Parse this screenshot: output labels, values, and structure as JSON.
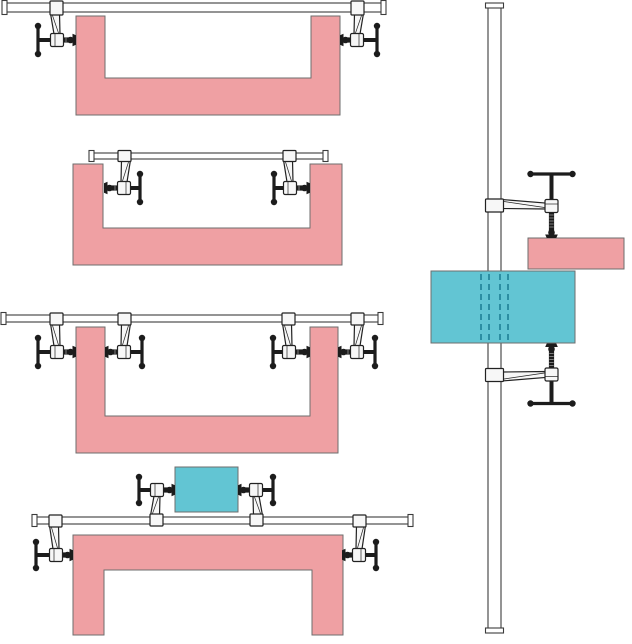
{
  "canvas": {
    "width": 632,
    "height": 644,
    "background": "#ffffff"
  },
  "colors": {
    "workpiece_pink": "#efa0a3",
    "workpiece_teal": "#62c5d3",
    "block_stroke": "#6e6e6e",
    "rail_fill": "#ffffff",
    "rail_stroke": "#3c3c3c",
    "metal_light": "#f7f7f7",
    "metal_stroke": "#222222",
    "metal_dark": "#1c1c1c",
    "thread_tick": "#8a8a8a",
    "hidden_edge_dash": "#1f8196"
  },
  "figures": [
    {
      "name": "diagram-channel-clamped-from-outside",
      "bars": [
        {
          "orient": "h",
          "x1": 3,
          "x2": 385,
          "yc": 7.5,
          "t": 9
        }
      ],
      "blocks": [
        {
          "kind": "workpiece-pink",
          "color": "workpiece_pink",
          "points": [
            [
              76,
              16
            ],
            [
              105,
              16
            ],
            [
              105,
              78
            ],
            [
              311,
              78
            ],
            [
              311,
              16
            ],
            [
              340,
              16
            ],
            [
              340,
              115
            ],
            [
              76,
              115
            ]
          ]
        }
      ],
      "clamps": [
        {
          "orient": "h",
          "x": 57,
          "y": 40,
          "flipX": false,
          "flipY": false,
          "armLen": 32,
          "barT": 9,
          "padDist": 19,
          "handleDist": 19,
          "handleLen": 14
        },
        {
          "orient": "h",
          "x": 357,
          "y": 40,
          "flipX": true,
          "flipY": false,
          "armLen": 32,
          "barT": 9,
          "padDist": 17,
          "handleDist": 20,
          "handleLen": 14
        }
      ]
    },
    {
      "name": "diagram-channel-spread-from-inside",
      "bars": [
        {
          "orient": "h",
          "x1": 90,
          "x2": 327,
          "yc": 156,
          "t": 6
        }
      ],
      "blocks": [
        {
          "kind": "workpiece-pink",
          "color": "workpiece_pink",
          "points": [
            [
              73,
              164
            ],
            [
              103,
              164
            ],
            [
              103,
              228
            ],
            [
              310,
              228
            ],
            [
              310,
              164
            ],
            [
              342,
              164
            ],
            [
              342,
              265
            ],
            [
              73,
              265
            ]
          ]
        }
      ],
      "clamps": [
        {
          "orient": "h",
          "x": 124,
          "y": 188,
          "flipX": true,
          "flipY": false,
          "armLen": 32,
          "barT": 6,
          "padDist": 20,
          "handleDist": 16,
          "handleLen": 14
        },
        {
          "orient": "h",
          "x": 290,
          "y": 188,
          "flipX": false,
          "flipY": false,
          "armLen": 32,
          "barT": 6,
          "padDist": 20,
          "handleDist": 16,
          "handleLen": 14
        }
      ]
    },
    {
      "name": "diagram-channel-walls-clamped-both-sides",
      "bars": [
        {
          "orient": "h",
          "x1": 2,
          "x2": 382,
          "yc": 318.5,
          "t": 7
        }
      ],
      "blocks": [
        {
          "kind": "workpiece-pink",
          "color": "workpiece_pink",
          "points": [
            [
              76,
              327
            ],
            [
              105,
              327
            ],
            [
              105,
              416
            ],
            [
              310,
              416
            ],
            [
              310,
              327
            ],
            [
              338,
              327
            ],
            [
              338,
              453
            ],
            [
              76,
              453
            ]
          ]
        }
      ],
      "clamps": [
        {
          "orient": "h",
          "x": 57,
          "y": 352,
          "flipX": false,
          "flipY": false,
          "armLen": 33,
          "barT": 7,
          "padDist": 19,
          "handleDist": 19,
          "handleLen": 14
        },
        {
          "orient": "h",
          "x": 124,
          "y": 352,
          "flipX": true,
          "flipY": false,
          "armLen": 33,
          "barT": 7,
          "padDist": 19,
          "handleDist": 18,
          "handleLen": 14
        },
        {
          "orient": "h",
          "x": 289,
          "y": 352,
          "flipX": false,
          "flipY": false,
          "armLen": 33,
          "barT": 7,
          "padDist": 21,
          "handleDist": 16,
          "handleLen": 14
        },
        {
          "orient": "h",
          "x": 357,
          "y": 352,
          "flipX": true,
          "flipY": false,
          "armLen": 33,
          "barT": 7,
          "padDist": 19,
          "handleDist": 18,
          "handleLen": 14
        }
      ]
    },
    {
      "name": "diagram-bridge-and-block-clamped-on-one-rail",
      "bars": [
        {
          "orient": "h",
          "x1": 33,
          "x2": 412,
          "yc": 520.5,
          "t": 7
        }
      ],
      "blocks": [
        {
          "kind": "workpiece-teal",
          "color": "workpiece_teal",
          "rect": [
            175,
            467,
            63,
            45
          ]
        },
        {
          "kind": "workpiece-pink",
          "color": "workpiece_pink",
          "points": [
            [
              73,
              535
            ],
            [
              343,
              535
            ],
            [
              343,
              635
            ],
            [
              312,
              635
            ],
            [
              312,
              570
            ],
            [
              104,
              570
            ],
            [
              104,
              635
            ],
            [
              73,
              635
            ]
          ]
        }
      ],
      "clamps": [
        {
          "orient": "h",
          "x": 157,
          "y": 490,
          "flipX": false,
          "flipY": true,
          "armLen": 30,
          "barT": 7,
          "padDist": 18,
          "handleDist": 18,
          "handleLen": 13
        },
        {
          "orient": "h",
          "x": 256,
          "y": 490,
          "flipX": true,
          "flipY": true,
          "armLen": 30,
          "barT": 7,
          "padDist": 18,
          "handleDist": 17,
          "handleLen": 13
        },
        {
          "orient": "h",
          "x": 56,
          "y": 555,
          "flipX": false,
          "flipY": false,
          "armLen": 34,
          "barT": 7,
          "padDist": 17,
          "handleDist": 20,
          "handleLen": 13
        },
        {
          "orient": "h",
          "x": 359,
          "y": 555,
          "flipX": true,
          "flipY": false,
          "armLen": 34,
          "barT": 7,
          "padDist": 17,
          "handleDist": 17,
          "handleLen": 13
        }
      ]
    },
    {
      "name": "diagram-vertical-rail-clamping-stacked-blocks",
      "bars": [
        {
          "orient": "v",
          "y1": 4,
          "y2": 632,
          "xc": 494.5,
          "t": 13
        }
      ],
      "blocks": [
        {
          "kind": "workpiece-teal",
          "color": "workpiece_teal",
          "rect": [
            431,
            271,
            144,
            72
          ],
          "dashes": {
            "xs": [
              481,
              489,
              500,
              508
            ],
            "y1": 274,
            "y2": 340
          }
        },
        {
          "kind": "workpiece-pink",
          "color": "workpiece_pink",
          "rect": [
            528,
            238,
            96,
            31
          ]
        }
      ],
      "clamps": [
        {
          "orient": "vtop",
          "x": 551.5,
          "y": 206,
          "armLen": 57,
          "barT": 13,
          "padDist": 32,
          "handleDist": 32,
          "handleLen": 21
        },
        {
          "orient": "vbottom",
          "x": 551.5,
          "y": 374.5,
          "armLen": 57,
          "barT": 13,
          "padDist": 31,
          "handleDist": 29,
          "handleLen": 21
        }
      ]
    }
  ]
}
